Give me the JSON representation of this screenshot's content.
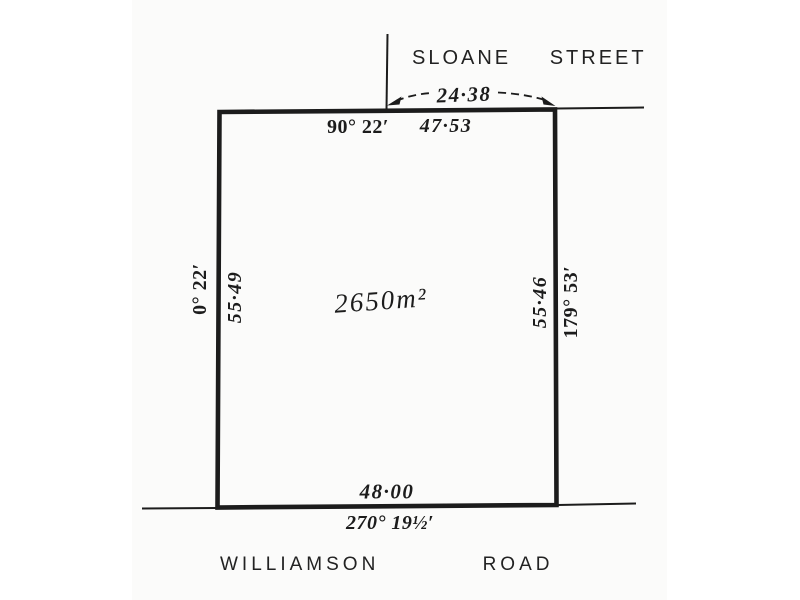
{
  "streets": {
    "top": "SLOANE STREET",
    "bottom": "WILLIAMSON ROAD"
  },
  "parcel": {
    "area_label": "2650m²",
    "frontage_dimension": "24·38",
    "boundaries": {
      "north": {
        "bearing": "90° 22′",
        "distance": "47·53"
      },
      "east": {
        "bearing": "179° 53′",
        "distance": "55·46"
      },
      "south": {
        "bearing": "270° 19½′",
        "distance": "48·00"
      },
      "west": {
        "bearing": "0° 22′",
        "distance": "55·49"
      }
    }
  },
  "colors": {
    "ink": "#1c1c1c",
    "paper": "#fbfbfa",
    "canvas": "#ffffff"
  }
}
